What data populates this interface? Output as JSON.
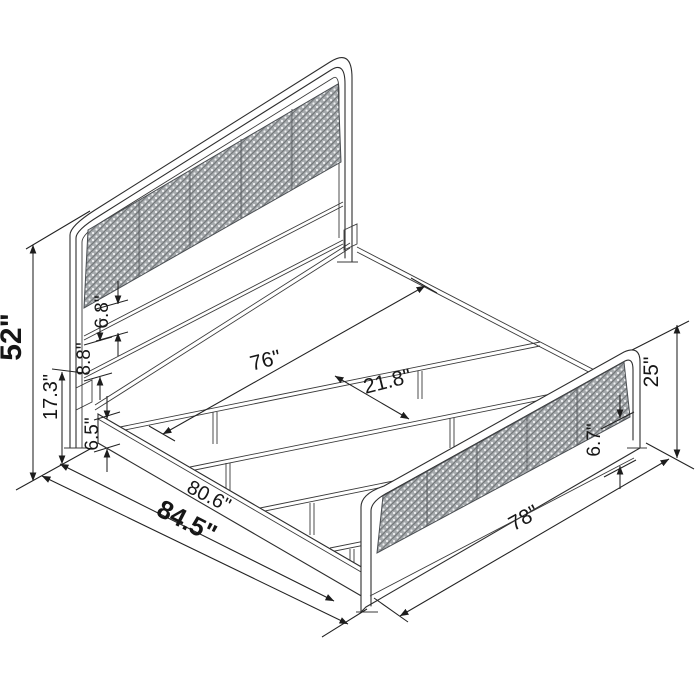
{
  "diagram": {
    "kind": "furniture-dimension-line-drawing",
    "background": "#ffffff",
    "line_color": "#2d2d2d",
    "panel_texture_color": "#a6aaad"
  },
  "annotations": [
    {
      "id": "dim-52",
      "label": "52\"",
      "bold": true
    },
    {
      "id": "dim-17-3",
      "label": "17.3\"",
      "bold": false
    },
    {
      "id": "dim-6-8",
      "label": "6.8\"",
      "bold": false
    },
    {
      "id": "dim-8-8",
      "label": "8.8\"",
      "bold": false
    },
    {
      "id": "dim-6-5",
      "label": "6.5\"",
      "bold": false
    },
    {
      "id": "dim-76",
      "label": "76\"",
      "bold": false
    },
    {
      "id": "dim-21-8",
      "label": "21.8\"",
      "bold": false
    },
    {
      "id": "dim-80-6",
      "label": "80.6\"",
      "bold": false
    },
    {
      "id": "dim-84-5",
      "label": "84.5\"",
      "bold": true
    },
    {
      "id": "dim-78",
      "label": "78\"",
      "bold": false
    },
    {
      "id": "dim-25",
      "label": "25\"",
      "bold": false
    },
    {
      "id": "dim-6-7",
      "label": "6.7\"",
      "bold": false
    }
  ]
}
